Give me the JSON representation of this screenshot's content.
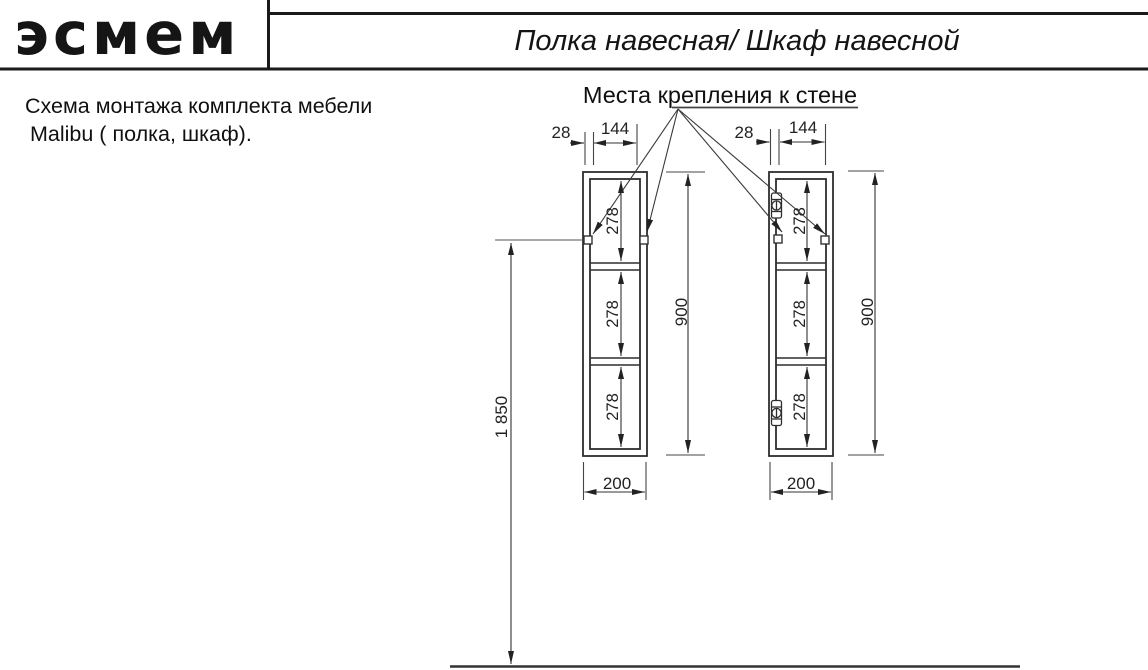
{
  "header": {
    "logo_text": "эсмем",
    "title": "Полка навесная/ Шкаф навесной"
  },
  "note": {
    "line1": "Схема монтажа комплекта мебели",
    "line2": "Malibu ( полка, шкаф)."
  },
  "drawing": {
    "callout_label": "Места крепления к стене",
    "dims": {
      "edge_offset": "28",
      "bracket_spacing": "144",
      "shelf_pitch": "278",
      "cabinet_height": "900",
      "cabinet_width": "200",
      "mount_height_from_floor": "1 850"
    },
    "items": {
      "left_unit": "полка (открытая, без фасада)",
      "right_unit": "шкаф (с петлями фасада)"
    }
  },
  "colors": {
    "line": "#2e2e2e",
    "thin_line": "#4a4a4a",
    "text": "#222222",
    "background": "#ffffff"
  }
}
